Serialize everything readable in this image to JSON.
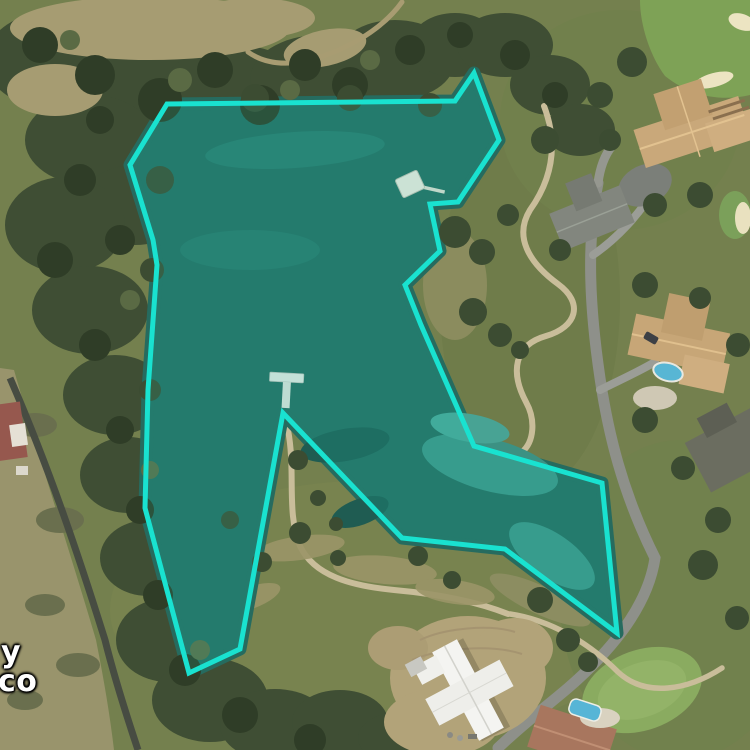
{
  "map": {
    "type": "aerial-imagery",
    "labels": [
      {
        "text": "y"
      },
      {
        "text": "co"
      }
    ]
  },
  "overlay": {
    "points": "167,104 455,101 474,73 499,140 458,202 430,204 440,251 405,285 421,325 474,446 602,483 617,633 505,549 402,538 283,413 240,649 189,673 145,508 148,390 157,265 153,240 130,165",
    "stroke_color": "#19e2d0",
    "fill_color": "rgba(25,230,212,0.13)",
    "stroke_width": "5"
  },
  "features": [
    "highlighted-lake-parcel",
    "north-dock",
    "south-t-dock",
    "perimeter-road",
    "golf-course",
    "mansions",
    "construction-building",
    "swimming-pools"
  ],
  "colors": {
    "water": "#266b5f",
    "water_shallow": "#3c9183",
    "overlay_stroke": "#19e2d0",
    "trees": "#3f4e34",
    "trees_dark": "#2f3d27",
    "grass": "#74804e",
    "field": "#99946c",
    "dirt": "#b2a379",
    "road": "#8e908a",
    "road_dark": "#474c42",
    "cart_path": "#c9bd9a",
    "roof_tan": "#c9a87a",
    "roof_gray": "#82867e",
    "roof_red": "#a8765e",
    "golf_green": "#8aab60",
    "bunker": "#ece4c2",
    "pool": "#58b6d4",
    "dock": "#e6e2d6",
    "label_text": "#ffffff"
  }
}
